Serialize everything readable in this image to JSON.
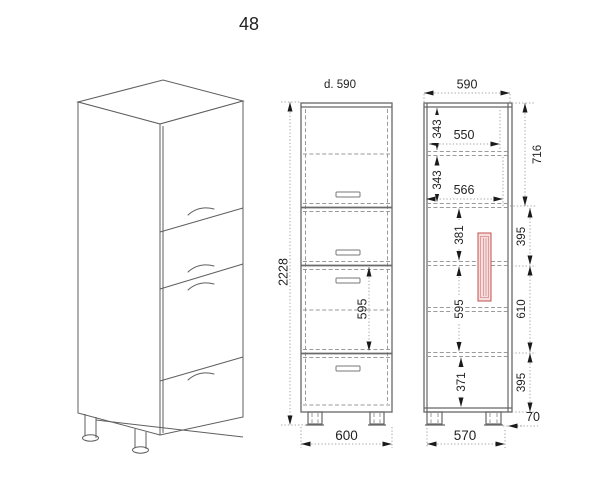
{
  "title": "48",
  "front_view": {
    "depth_label": "d. 590",
    "dim_total_height": "2228",
    "dim_middle_drawer_height": "595",
    "dim_width": "600"
  },
  "side_view": {
    "dim_top_width": "590",
    "dim_upper_shelf_height": "343",
    "dim_upper_shelf_depth": "550",
    "dim_lower_shelf_height": "343",
    "dim_lower_shelf_depth": "566",
    "dim_drawer1_inner_height": "381",
    "dim_drawer2_inner_height": "595",
    "dim_drawer3_inner_height": "371",
    "dim_door_front_height": "716",
    "dim_drawer1_front_height": "395",
    "dim_drawer2_front_height": "610",
    "dim_drawer3_front_height": "395",
    "dim_feet_height": "70",
    "dim_bottom_width": "570"
  },
  "colors": {
    "line": "#666666",
    "dashed_line": "#9a9a9a",
    "dimension_line": "#a3a3a3",
    "text": "#222222",
    "section_red": "#c0504d",
    "section_red_fill": "#f7dede"
  }
}
